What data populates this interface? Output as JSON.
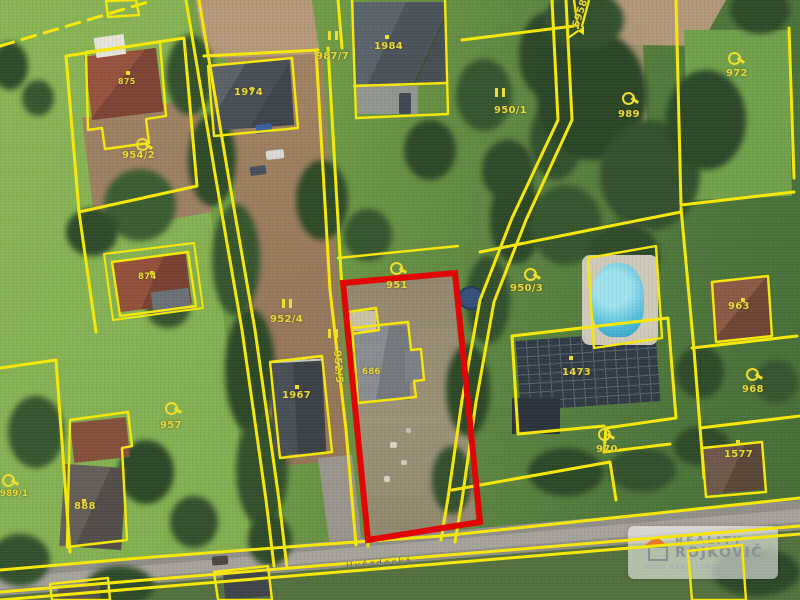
{
  "map": {
    "type": "cadastral-parcel-overlay-on-aerial-photo",
    "street_name": "Hvězdecká",
    "highlighted_parcel_number": "951",
    "colors": {
      "cadastral_line": "#f6e70b",
      "highlight_outline": "#e10505",
      "label_text": "#e9d83c"
    },
    "parcel_labels": [
      {
        "text": "987/7"
      },
      {
        "text": "1984"
      },
      {
        "text": "1974"
      },
      {
        "text": "875"
      },
      {
        "text": "954/2"
      },
      {
        "text": "6958"
      },
      {
        "text": "950/1"
      },
      {
        "text": "989"
      },
      {
        "text": "972"
      },
      {
        "text": "874"
      },
      {
        "text": "952/4"
      },
      {
        "text": "952/5"
      },
      {
        "text": "1967"
      },
      {
        "text": "951"
      },
      {
        "text": "686"
      },
      {
        "text": "950/3"
      },
      {
        "text": "1473"
      },
      {
        "text": "963"
      },
      {
        "text": "968"
      },
      {
        "text": "1577"
      },
      {
        "text": "970"
      },
      {
        "text": "957"
      },
      {
        "text": "989/1"
      },
      {
        "text": "888"
      }
    ]
  },
  "watermark": {
    "brand_top": "REALITY",
    "brand_bottom": "ROJKOVIČ",
    "url": "WWW.REALITYROJKOVIC.CZ",
    "accent_color": "#e8762a",
    "text_color": "#8e9093"
  }
}
